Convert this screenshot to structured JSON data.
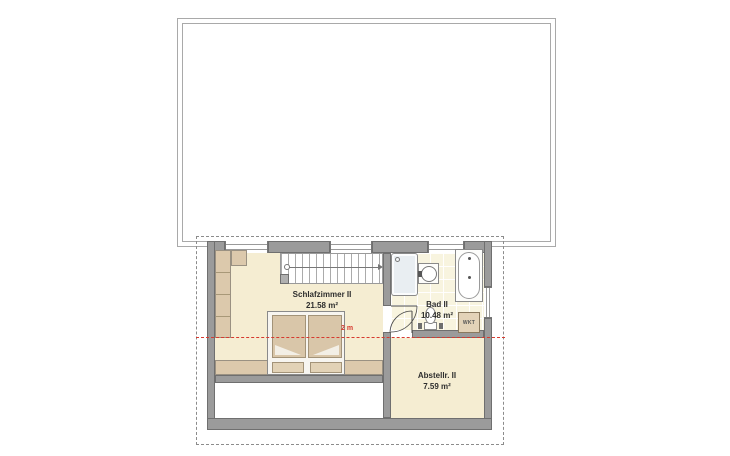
{
  "plan_type": "floor-plan",
  "rooms": {
    "schlafzimmer": {
      "name": "Schlafzimmer II",
      "area": "21.58 m²"
    },
    "bad": {
      "name": "Bad II",
      "area": "10.48 m²"
    },
    "abstellraum": {
      "name": "Abstellr. II",
      "area": "7.59 m²"
    }
  },
  "annotations": {
    "headroom": "2 m",
    "appliance": "WKT"
  },
  "colors": {
    "wall": "#9b9b9b",
    "floor": "#f5edd2",
    "tile": "#f8f4df",
    "furniture": "#dcc9ac",
    "shower": "#e9eef2",
    "accent_red": "#d63a2f",
    "outline": "#6f6f6f"
  }
}
